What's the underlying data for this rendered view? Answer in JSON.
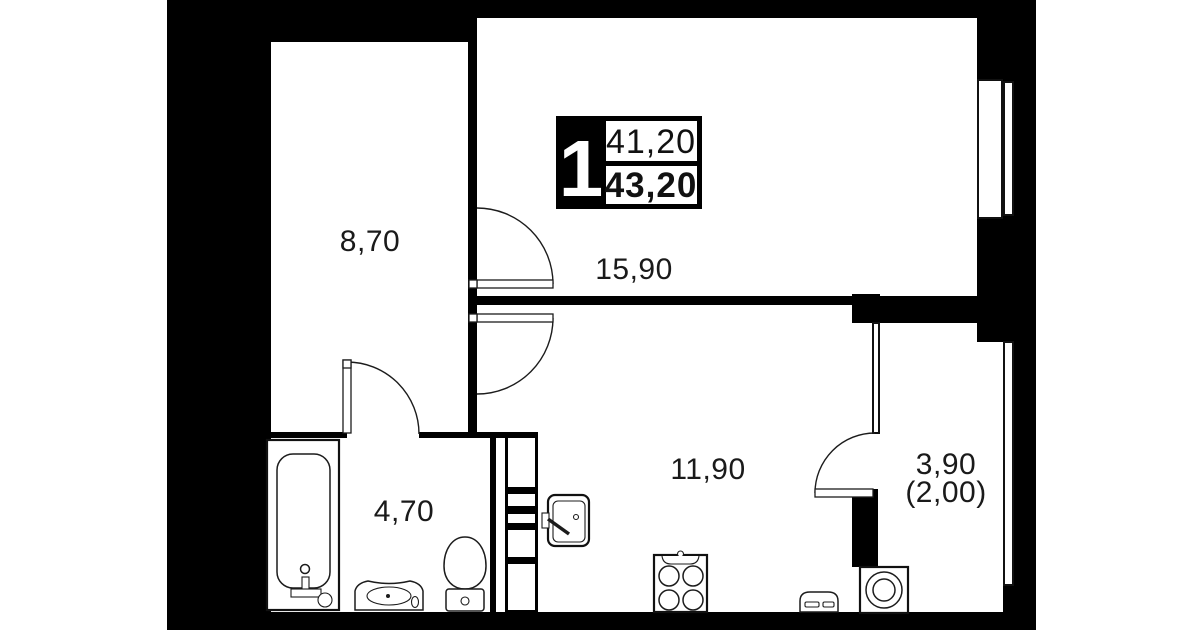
{
  "badge": {
    "rooms_count": "1",
    "area_living": "41,20",
    "area_total": "43,20"
  },
  "labels": {
    "hallway": "8,70",
    "living": "15,90",
    "kitchen": "11,90",
    "bathroom": "4,70",
    "balcony": "3,90",
    "balcony_reduced": "(2,00)"
  },
  "colors": {
    "wall": "#000000",
    "floor": "#ffffff",
    "line": "#1c1c1c"
  }
}
